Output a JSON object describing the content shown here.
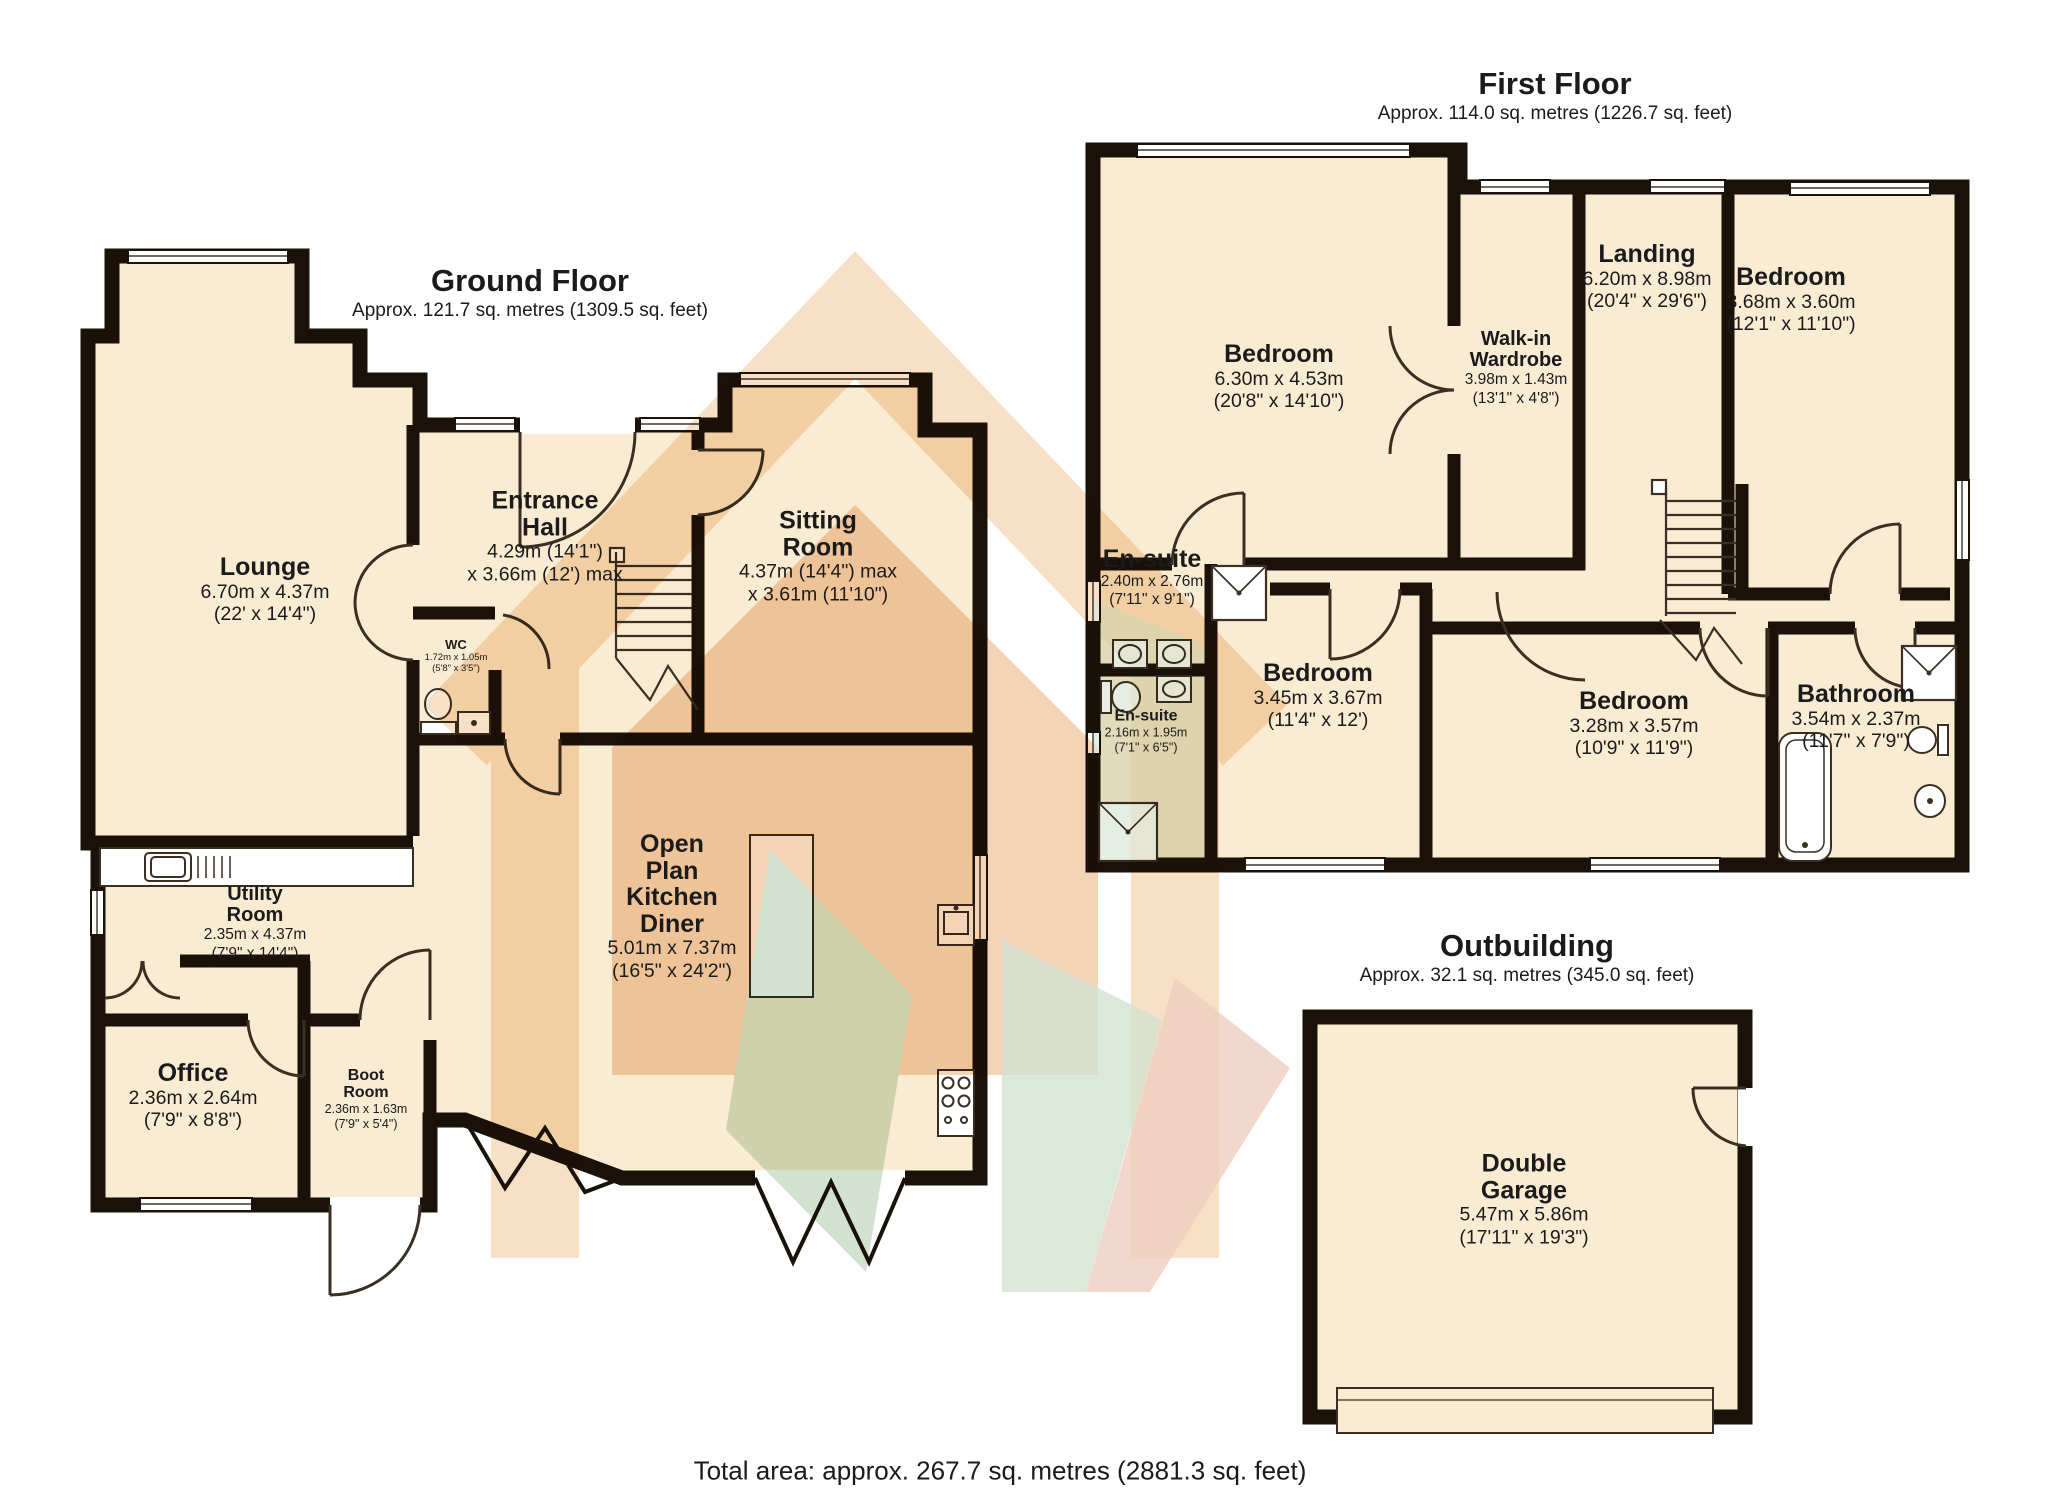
{
  "colors": {
    "floor": "#FAEBD3",
    "wall": "#1A1208",
    "door_arc": "#3a2f22",
    "window_fill": "#ffffff",
    "wm_orange": "#f0c28c",
    "wm_deep_orange": "#e8a96f",
    "wm_green": "#a8c6a2",
    "wm_salmon": "#dd9d80"
  },
  "ground_floor": {
    "title": "Ground Floor",
    "subtitle": "Approx. 121.7 sq. metres (1309.5 sq. feet)",
    "rooms": {
      "lounge": {
        "name": "Lounge",
        "metric": "6.70m x 4.37m",
        "imperial": "(22' x 14'4\")"
      },
      "entrance_hall": {
        "name": "Entrance Hall",
        "metric": "4.29m (14'1\")",
        "imperial": "x 3.66m (12') max"
      },
      "sitting_room": {
        "name": "Sitting Room",
        "metric": "4.37m (14'4\") max",
        "imperial": "x 3.61m (11'10\")"
      },
      "wc": {
        "name": "WC",
        "metric": "1.72m x 1.05m",
        "imperial": "(5'8\" x 3'5\")"
      },
      "kitchen": {
        "name": "Open Plan Kitchen Diner",
        "metric": "5.01m x 7.37m",
        "imperial": "(16'5\" x 24'2\")"
      },
      "utility": {
        "name": "Utility Room",
        "metric": "2.35m x 4.37m",
        "imperial": "(7'9\" x 14'4\")"
      },
      "office": {
        "name": "Office",
        "metric": "2.36m x 2.64m",
        "imperial": "(7'9\" x 8'8\")"
      },
      "boot": {
        "name": "Boot Room",
        "metric": "2.36m x 1.63m",
        "imperial": "(7'9\" x 5'4\")"
      }
    }
  },
  "first_floor": {
    "title": "First Floor",
    "subtitle": "Approx. 114.0 sq. metres (1226.7 sq. feet)",
    "rooms": {
      "bedroom1": {
        "name": "Bedroom",
        "metric": "6.30m x 4.53m",
        "imperial": "(20'8\" x 14'10\")"
      },
      "wardrobe": {
        "name": "Walk-in Wardrobe",
        "metric": "3.98m x 1.43m",
        "imperial": "(13'1\" x 4'8\")"
      },
      "landing": {
        "name": "Landing",
        "metric": "6.20m x 8.98m",
        "imperial": "(20'4\" x 29'6\")"
      },
      "bedroom2": {
        "name": "Bedroom",
        "metric": "3.68m x 3.60m",
        "imperial": "(12'1\" x 11'10\")"
      },
      "ensuite1": {
        "name": "En-suite",
        "metric": "2.40m x 2.76m",
        "imperial": "(7'11\" x 9'1\")"
      },
      "ensuite2": {
        "name": "En-suite",
        "metric": "2.16m x 1.95m",
        "imperial": "(7'1\" x 6'5\")"
      },
      "bedroom3": {
        "name": "Bedroom",
        "metric": "3.45m x 3.67m",
        "imperial": "(11'4\" x 12')"
      },
      "bedroom4": {
        "name": "Bedroom",
        "metric": "3.28m x 3.57m",
        "imperial": "(10'9\" x 11'9\")"
      },
      "bathroom": {
        "name": "Bathroom",
        "metric": "3.54m x 2.37m",
        "imperial": "(11'7\" x 7'9\")"
      }
    }
  },
  "outbuilding": {
    "title": "Outbuilding",
    "subtitle": "Approx. 32.1 sq. metres (345.0 sq. feet)",
    "rooms": {
      "garage": {
        "name": "Double Garage",
        "metric": "5.47m x 5.86m",
        "imperial": "(17'11\" x 19'3\")"
      }
    }
  },
  "footer": {
    "total": "Total area: approx. 267.7 sq. metres (2881.3 sq. feet)"
  }
}
